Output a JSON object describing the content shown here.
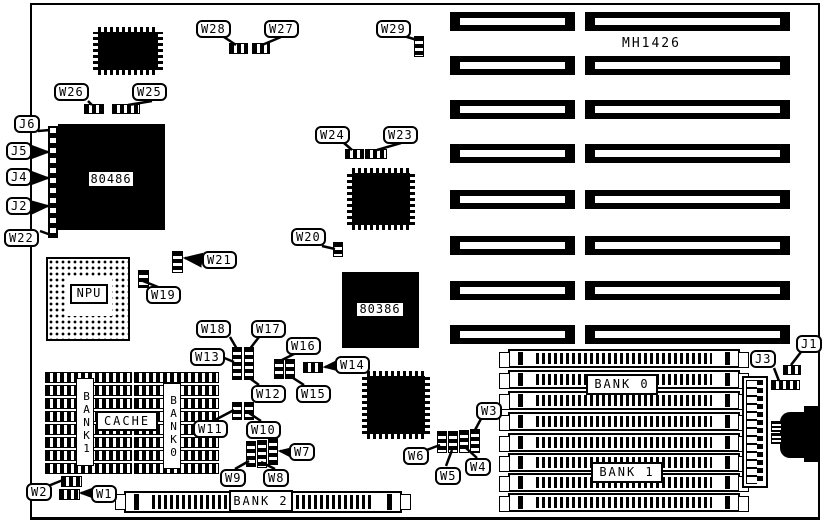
{
  "board": {
    "model": "MH1426"
  },
  "chips": {
    "cpu": "80486",
    "npu": "NPU",
    "pga386": "80386"
  },
  "memory": {
    "bank0": "BANK 0",
    "bank1": "BANK 1",
    "bank2": "BANK 2"
  },
  "cache": {
    "label": "CACHE",
    "bank1": "BANK1",
    "bank0": "BANK0"
  },
  "callouts": {
    "j1": "J1",
    "j2": "J2",
    "j3": "J3",
    "j4": "J4",
    "j5": "J5",
    "j6": "J6",
    "w1": "W1",
    "w2": "W2",
    "w3": "W3",
    "w4": "W4",
    "w5": "W5",
    "w6": "W6",
    "w7": "W7",
    "w8": "W8",
    "w9": "W9",
    "w10": "W10",
    "w11": "W11",
    "w12": "W12",
    "w13": "W13",
    "w14": "W14",
    "w15": "W15",
    "w16": "W16",
    "w17": "W17",
    "w18": "W18",
    "w19": "W19",
    "w20": "W20",
    "w21": "W21",
    "w22": "W22",
    "w23": "W23",
    "w24": "W24",
    "w25": "W25",
    "w26": "W26",
    "w27": "W27",
    "w28": "W28",
    "w29": "W29"
  }
}
